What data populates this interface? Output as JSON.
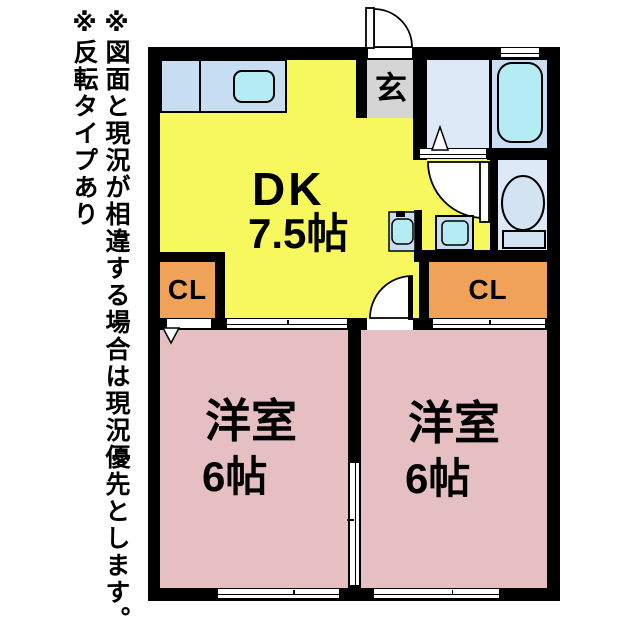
{
  "side_notes": {
    "disclaimer": "※図面と現況が相違する場合は現況優先とします。",
    "reversal": "※反転タイプあり"
  },
  "floorplan": {
    "dk": {
      "name": "DK",
      "size": "7.5帖"
    },
    "entrance": {
      "name": "玄"
    },
    "closet_left": {
      "name": "CL"
    },
    "closet_right": {
      "name": "CL"
    },
    "room_left": {
      "name": "洋室",
      "size": "6帖"
    },
    "room_right": {
      "name": "洋室",
      "size": "6帖"
    }
  },
  "colors": {
    "wall": "#000000",
    "dk_fill": "#f7f75e",
    "room_fill": "#e5bfc2",
    "closet_fill": "#efa258",
    "entrance_fill": "#d5d5d5",
    "washroom_fill": "#dde9f6",
    "bath_fill": "#cbdff4",
    "counter_fill": "#c7ddf2",
    "fixture_fill": "#b5ebf3"
  }
}
